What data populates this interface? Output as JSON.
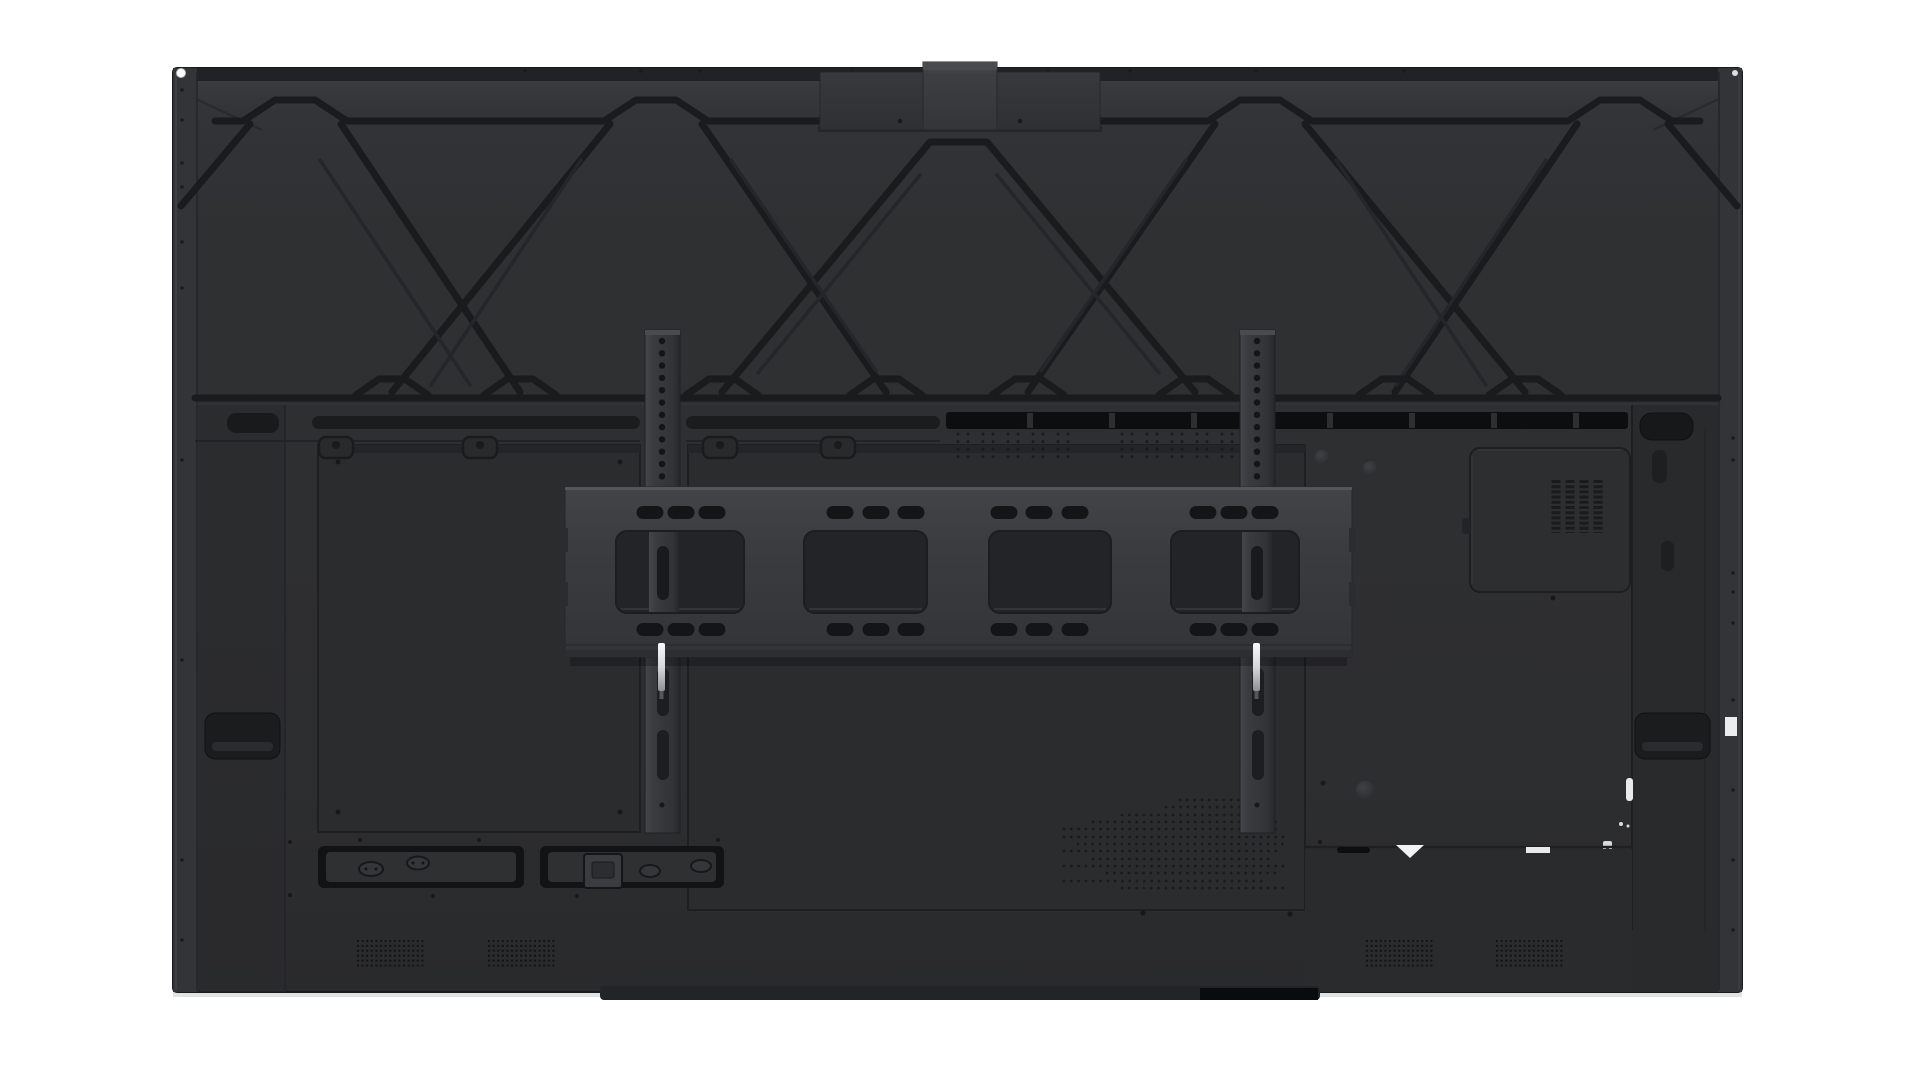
{
  "image": {
    "kind": "product-photo",
    "subject": "rear view of a large interactive flat panel display with wall-mount bracket",
    "background_color": "#ffffff"
  },
  "palette": {
    "bg": "#ffffff",
    "panel_top": "#35363a",
    "panel_mid": "#2e2f31",
    "panel_low": "#2a2b2d",
    "bezel_hi": "#46474b",
    "groove": "#1a1b1d",
    "groove_soft": "#24262a",
    "recess": "#2b2c2e",
    "recess_line": "#1e1f21",
    "band_black": "#0d0e0f",
    "slot": "#191a1c",
    "rail_light": "#404144",
    "rail_mid": "#353639",
    "rail_dark": "#28292b",
    "bracket_hi": "#55565a",
    "bracket_light": "#404145",
    "bracket_mid": "#3a3b3e",
    "bracket_low": "#323336",
    "cutout": "#232428",
    "pill": "#141517",
    "pin_metal": "#f2f2f3",
    "label_white": "#e9eaeb",
    "column": "#292a2c",
    "shadow": "#c9cacb"
  },
  "parts": {
    "rear-housing": "dark charcoal rear cover of the display",
    "rib-lattice": "diamond reinforcement ribs stamped across the upper half",
    "camera-mount-plate": "top-center accessory mounting plate with raised block",
    "vesa-rails": "two vertical VESA mounting rails with hole columns",
    "wall-mount-bracket": "horizontal wall-mount bar with slots and four large cutouts",
    "locking-pins": "bright metal locking pins under the bracket",
    "vent-band": "black ventilation slot band",
    "module-door": "square compute-module cover with vertical slat vents",
    "carry-handles": "recessed carry handles (top corners and sides)",
    "connector-recesses": "two bottom connector bays with oval sockets and power inlet",
    "speaker-grilles": "four perforated speaker dot grids near bottom",
    "perforation-field": "perforated cooling dots on lower center plate",
    "foot-strip": "thin foot protrusion along bottom edge"
  },
  "figure": {
    "rails": {
      "x": [
        645,
        1240
      ],
      "width": 35,
      "y": 330,
      "height": 503,
      "holes": {
        "cx_offset": 17,
        "y_start": 341,
        "dy": 12.3,
        "count": 12,
        "r": 3.2
      },
      "slots": [
        [
          668,
          48
        ],
        [
          730,
          50
        ]
      ],
      "slot_offset": 12,
      "slot_w": 12,
      "pin": {
        "offset": 13,
        "y": 643,
        "w": 7,
        "h": 48
      }
    },
    "bracket": {
      "pill_rows": [
        506,
        623
      ],
      "pill_groups": [
        [
          650,
          681,
          712
        ],
        [
          840,
          876,
          911
        ],
        [
          1004,
          1039,
          1075
        ],
        [
          1203,
          1234,
          1265
        ]
      ],
      "pill_w": 27,
      "pill_h": 13,
      "cutouts": [
        [
          616,
          128
        ],
        [
          804,
          123
        ],
        [
          989,
          122
        ],
        [
          1171,
          128
        ]
      ],
      "cutout_y": 531,
      "cutout_h": 82
    },
    "vent": {
      "separators": [
        1030,
        1112,
        1194,
        1330,
        1412,
        1494,
        1576
      ]
    },
    "dot_patches": {
      "y": 434,
      "rows": 4,
      "dy": 7.6,
      "r": 1.5,
      "pair_offsets": [
        0,
        10,
        25,
        35,
        50,
        60,
        75,
        85,
        100,
        110
      ],
      "bases": [
        958,
        1122
      ]
    },
    "perforation": {
      "dx": 7.3,
      "r": 1.4,
      "rows": [
        [
          800,
          1180,
          1252
        ],
        [
          807,
          1166,
          1266
        ],
        [
          815,
          1122,
          1273
        ],
        [
          822,
          1093,
          1280
        ],
        [
          829,
          1064,
          1280
        ],
        [
          837,
          1064,
          1287
        ],
        [
          844,
          1078,
          1287
        ],
        [
          851,
          1064,
          1280
        ],
        [
          859,
          1093,
          1273
        ],
        [
          866,
          1064,
          1287
        ],
        [
          873,
          1107,
          1280
        ],
        [
          881,
          1064,
          1266
        ],
        [
          888,
          1122,
          1287
        ]
      ]
    },
    "speakers": {
      "xs": [
        358,
        489,
        1367,
        1497
      ],
      "y": 941,
      "cols": 15,
      "rows": 6,
      "dx": 4.6,
      "dy": 4.9,
      "r": 1.15
    },
    "truss_joints": [
      392,
      520,
      722,
      886,
      1028,
      1195,
      1395,
      1525
    ],
    "bezel_screws": {
      "left_x": 182,
      "left_ys": [
        90,
        120,
        163,
        187,
        242,
        288,
        460,
        660,
        860,
        940
      ],
      "right_x": 1733,
      "right_ys": [
        438,
        460,
        573,
        592,
        623,
        700,
        790,
        860,
        930
      ],
      "top_y": 71,
      "top_xs": [
        525,
        641,
        700,
        852,
        932,
        1048,
        1130,
        1256,
        1404
      ]
    },
    "door_slats": {
      "x0": 1556,
      "n": 4,
      "w": 9,
      "gap": 5,
      "y": 480,
      "h": 53
    }
  }
}
